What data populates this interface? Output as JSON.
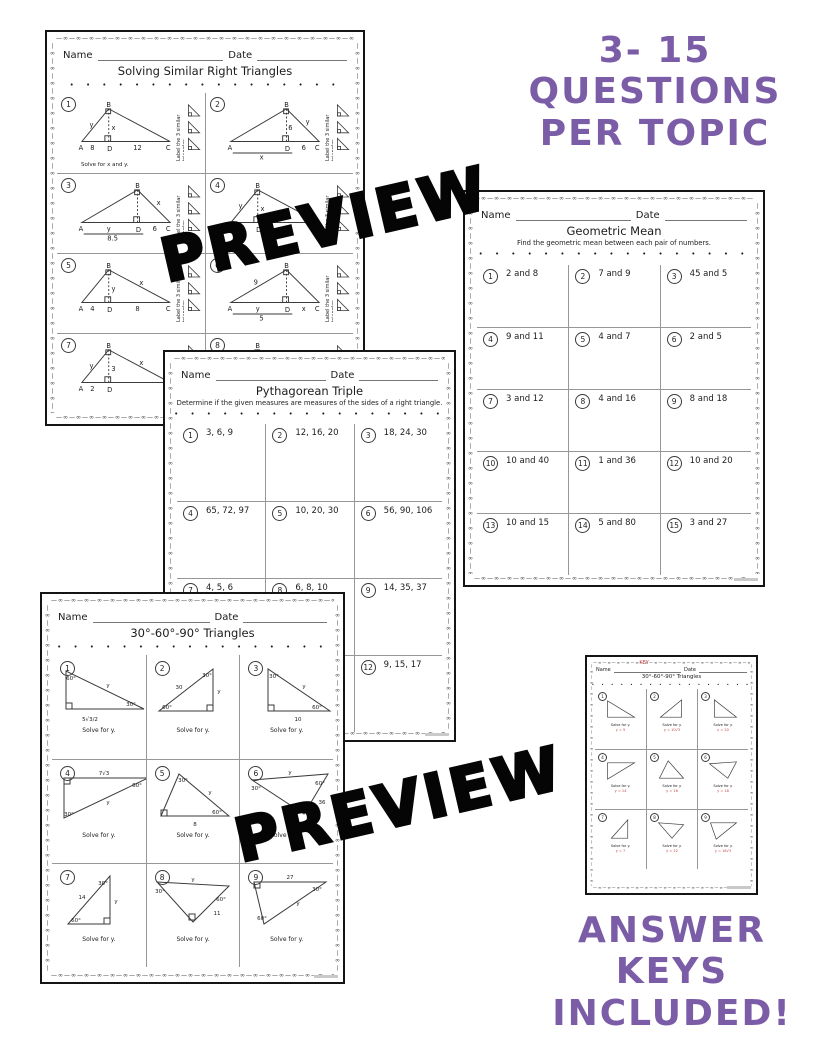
{
  "decor": {
    "ornament": "—∞",
    "dots": "• • • • • • • • • • • • • • • • •"
  },
  "watermark": {
    "text": "PREVIEW"
  },
  "callout_top": {
    "line1": "3- 15",
    "line2": "QUESTIONS",
    "line3": "PER TOPIC"
  },
  "callout_bottom": {
    "line1": "ANSWER",
    "line2": "KEYS",
    "line3": "INCLUDED!"
  },
  "colors": {
    "accent_purple": "#7b5ca7",
    "answer_red": "#c04343"
  },
  "page1": {
    "name_label": "Name",
    "date_label": "Date",
    "title": "Solving Similar Right Triangles",
    "rail_text": "Label the 3 similar triangles.",
    "problems": [
      {
        "num": "1",
        "A": "A",
        "B": "B",
        "C": "C",
        "D": "D",
        "left": "y",
        "alt": "x",
        "right": "",
        "seg1": "8",
        "seg2": "12",
        "bracket": "",
        "caption": "Solve for x and y."
      },
      {
        "num": "2",
        "A": "A",
        "B": "B",
        "C": "C",
        "D": "D",
        "left": "",
        "alt": "6",
        "right": "y",
        "seg1": "",
        "seg2": "6",
        "bracket": "x",
        "caption": ""
      },
      {
        "num": "3",
        "A": "A",
        "B": "B",
        "C": "C",
        "D": "D",
        "left": "",
        "alt": "",
        "right": "x",
        "seg1": "y",
        "seg2": "6",
        "bracket": "8.5",
        "caption": ""
      },
      {
        "num": "4",
        "A": "A",
        "B": "B",
        "C": "C",
        "D": "D",
        "left": "y",
        "alt": "x",
        "right": "",
        "seg1": "2",
        "seg2": "8",
        "bracket": "",
        "caption": ""
      },
      {
        "num": "5",
        "A": "A",
        "B": "B",
        "C": "C",
        "D": "D",
        "left": "",
        "alt": "y",
        "right": "x",
        "seg1": "4",
        "seg2": "8",
        "bracket": "",
        "caption": ""
      },
      {
        "num": "6",
        "A": "A",
        "B": "B",
        "C": "C",
        "D": "D",
        "left": "9",
        "alt": "",
        "right": "",
        "seg1": "y",
        "seg2": "x",
        "bracket": "5",
        "caption": ""
      },
      {
        "num": "7",
        "A": "A",
        "B": "B",
        "C": "C",
        "D": "D",
        "left": "y",
        "alt": "3",
        "right": "x",
        "seg1": "2",
        "seg2": "",
        "bracket": "",
        "caption": ""
      },
      {
        "num": "8",
        "A": "",
        "B": "B",
        "C": "",
        "D": "",
        "left": "12",
        "alt": "",
        "right": "",
        "seg1": "",
        "seg2": "",
        "bracket": "",
        "caption": ""
      }
    ]
  },
  "page2": {
    "name_label": "Name",
    "date_label": "Date",
    "title": "Geometric Mean",
    "subtitle": "Find the geometric mean between each pair of numbers.",
    "problems": [
      {
        "num": "1",
        "text": "2 and 8"
      },
      {
        "num": "2",
        "text": "7 and 9"
      },
      {
        "num": "3",
        "text": "45 and 5"
      },
      {
        "num": "4",
        "text": "9 and 11"
      },
      {
        "num": "5",
        "text": "4 and 7"
      },
      {
        "num": "6",
        "text": "2 and 5"
      },
      {
        "num": "7",
        "text": "3 and 12"
      },
      {
        "num": "8",
        "text": "4 and 16"
      },
      {
        "num": "9",
        "text": "8 and 18"
      },
      {
        "num": "10",
        "text": "10 and 40"
      },
      {
        "num": "11",
        "text": "1 and 36"
      },
      {
        "num": "12",
        "text": "10 and 20"
      },
      {
        "num": "13",
        "text": "10 and 15"
      },
      {
        "num": "14",
        "text": "5 and 80"
      },
      {
        "num": "15",
        "text": "3 and 27"
      }
    ]
  },
  "page3": {
    "name_label": "Name",
    "date_label": "Date",
    "title": "Pythagorean Triple",
    "subtitle": "Determine if the given measures are measures of the sides of a right triangle.",
    "problems": [
      {
        "num": "1",
        "text": "3, 6, 9"
      },
      {
        "num": "2",
        "text": "12, 16, 20"
      },
      {
        "num": "3",
        "text": "18, 24, 30"
      },
      {
        "num": "4",
        "text": "65, 72, 97"
      },
      {
        "num": "5",
        "text": "10, 20, 30"
      },
      {
        "num": "6",
        "text": "56, 90, 106"
      },
      {
        "num": "7",
        "text": "4, 5, 6"
      },
      {
        "num": "8",
        "text": "6, 8, 10"
      },
      {
        "num": "9",
        "text": "14, 35, 37"
      },
      {
        "num": "",
        "text": ""
      },
      {
        "num": "",
        "text": ""
      },
      {
        "num": "12",
        "text": "9, 15, 17"
      }
    ]
  },
  "page4": {
    "name_label": "Name",
    "date_label": "Date",
    "title": "30°-60°-90° Triangles",
    "caption": "Solve for y.",
    "problems": [
      {
        "num": "1",
        "labels": [
          "60°",
          "y",
          "30°",
          "5√3/2"
        ]
      },
      {
        "num": "2",
        "labels": [
          "30°",
          "30",
          "y",
          "60°"
        ]
      },
      {
        "num": "3",
        "labels": [
          "30°",
          "y",
          "60°",
          "10"
        ]
      },
      {
        "num": "4",
        "labels": [
          "7√3",
          "60°",
          "y",
          "30°"
        ]
      },
      {
        "num": "5",
        "labels": [
          "30°",
          "y",
          "60°",
          "8"
        ]
      },
      {
        "num": "6",
        "labels": [
          "30°",
          "y",
          "60°",
          "36"
        ]
      },
      {
        "num": "7",
        "labels": [
          "30°",
          "14",
          "y",
          "60°"
        ]
      },
      {
        "num": "8",
        "labels": [
          "30°",
          "y",
          "60°",
          "11"
        ]
      },
      {
        "num": "9",
        "labels": [
          "27",
          "30°",
          "y",
          "60°"
        ]
      }
    ]
  },
  "page5": {
    "name_label": "Name",
    "key": "KEY",
    "date_label": "Date",
    "title": "30°-60°-90° Triangles",
    "caption": "Solve for y.",
    "problems": [
      {
        "num": "1",
        "answer": "y = 5"
      },
      {
        "num": "2",
        "answer": "y = 10√3"
      },
      {
        "num": "3",
        "answer": "y = 20"
      },
      {
        "num": "4",
        "answer": "y = 14"
      },
      {
        "num": "5",
        "answer": "y = 16"
      },
      {
        "num": "6",
        "answer": "y = 18"
      },
      {
        "num": "7",
        "answer": "y = 7"
      },
      {
        "num": "8",
        "answer": "y = 22"
      },
      {
        "num": "9",
        "answer": "y = 18√3"
      }
    ]
  }
}
